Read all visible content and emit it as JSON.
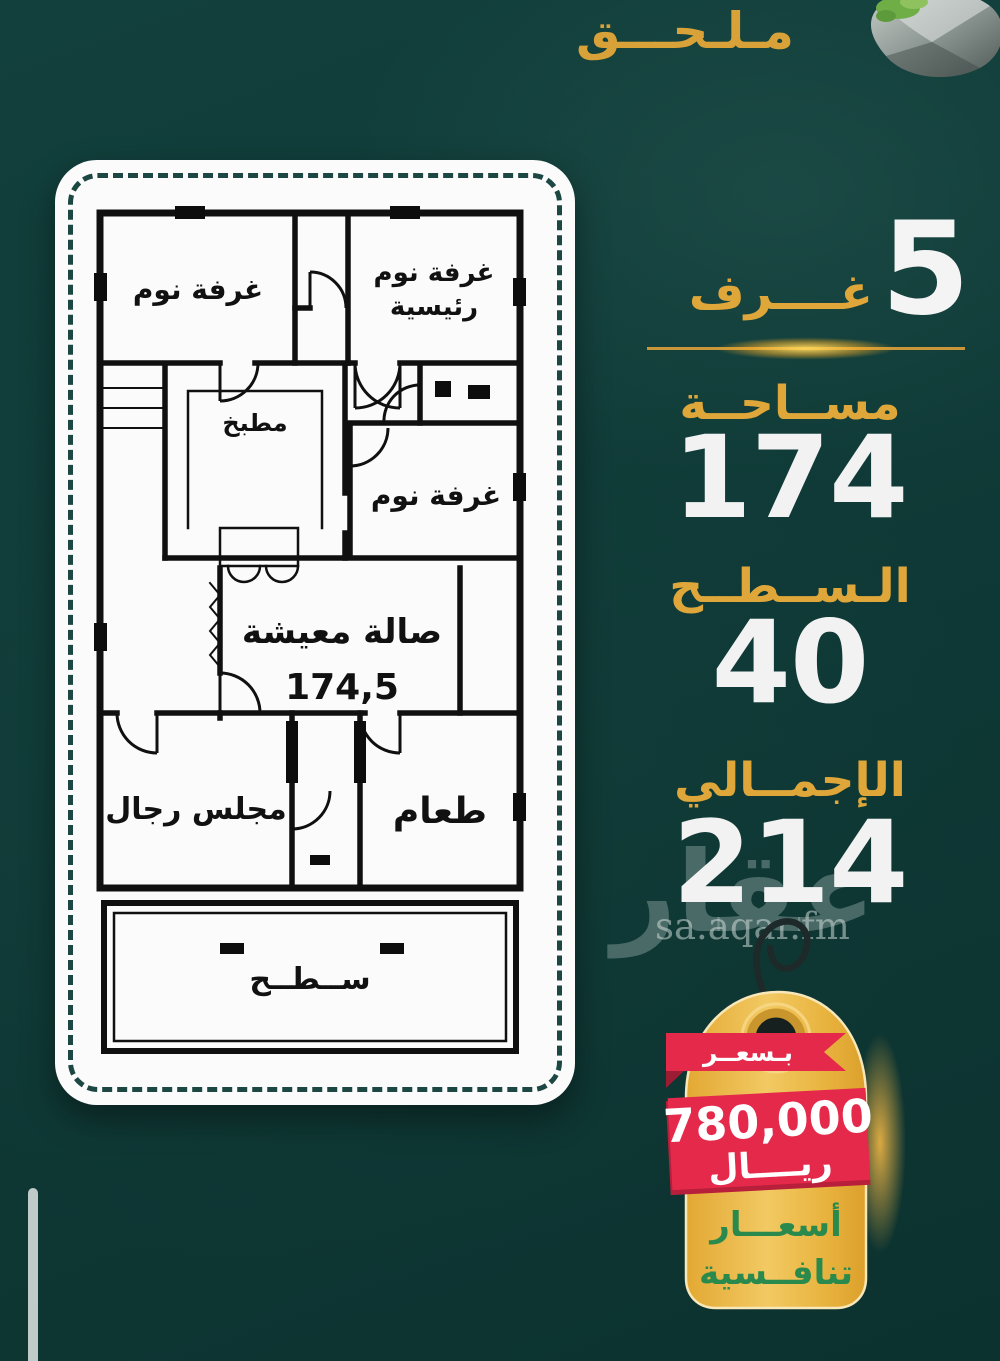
{
  "page": {
    "title": "مـلـحـــق"
  },
  "floor_plan": {
    "rooms": {
      "bedroom_top": "غرفة نوم",
      "master_bedroom_line1": "غرفة نوم",
      "master_bedroom_line2": "رئيسية",
      "kitchen": "مطبخ",
      "bedroom_mid": "غرفة نوم",
      "living_room": "صالة معيشة",
      "living_area_value": "174,5",
      "majlis": "مجلس رجال",
      "dining": "طعام",
      "terrace": "ســطــح"
    }
  },
  "stats": {
    "rooms_value": "5",
    "rooms_label": "غــــرف",
    "area_label": "مســاحــة",
    "area_value": "174",
    "roof_label": "الـســطــح",
    "roof_value": "40",
    "total_label": "الإجمــالي",
    "total_value": "214"
  },
  "watermark": {
    "arabic": "عقار",
    "domain": "sa.aqar.fm"
  },
  "price_tag": {
    "ribbon_label": "بـسعــر",
    "amount": "780,000",
    "currency": "ريــــال",
    "tagline_line1": "أسعـــار",
    "tagline_line2": "تنافــسية"
  },
  "colors": {
    "background_teal": "#0F3A37",
    "accent_gold": "#DFA63A",
    "number_white": "#F2F2F2",
    "ribbon_red": "#E5294B",
    "tag_gold": "#EDB944",
    "tagline_green": "#2A8A4D"
  }
}
